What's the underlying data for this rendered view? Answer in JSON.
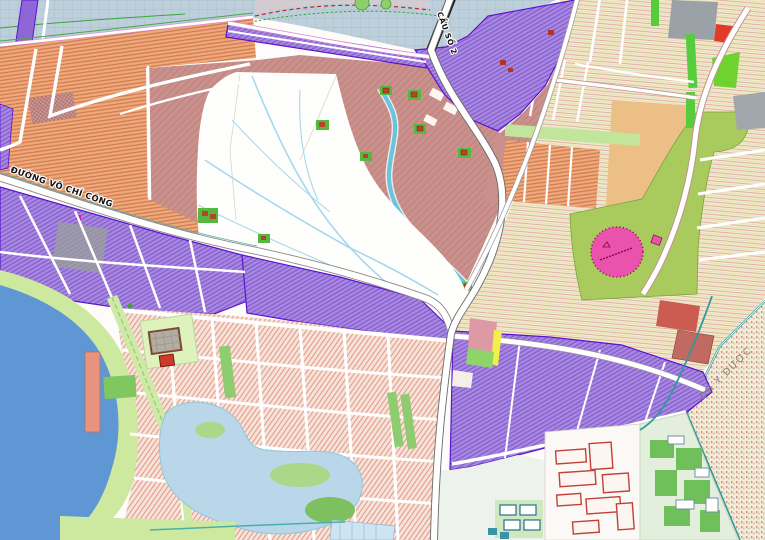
{
  "map": {
    "type": "urban-zoning-plan-screenshot",
    "labels": {
      "road": "ĐƯỜNG VÕ CHÍ CÔNG",
      "bridge": "CẦU SỐ 2",
      "university": "ĐH Y DƯỢC"
    },
    "palette": {
      "water": "#bccfda",
      "lake": "#5e97d4",
      "shore_green": "#cde9a0",
      "orange_residential": "#eda97a",
      "rose_village": "#c9908c",
      "pink_residential": "#f6e3da",
      "purple_mixed_use": "#a688dd",
      "purple_outline": "#5b13cf",
      "cream_blocks": "#f4ebc6",
      "green_field": "#a9cb5e",
      "stadium_pink": "#ea52ae",
      "tan_block": "#ecbf86",
      "campus_green": "#6fbf5a",
      "teal_road": "#2f9a9a",
      "red_block": "#e03a28",
      "gray_block": "#9aa2a8",
      "pond_blue": "#b9d7e8"
    }
  }
}
